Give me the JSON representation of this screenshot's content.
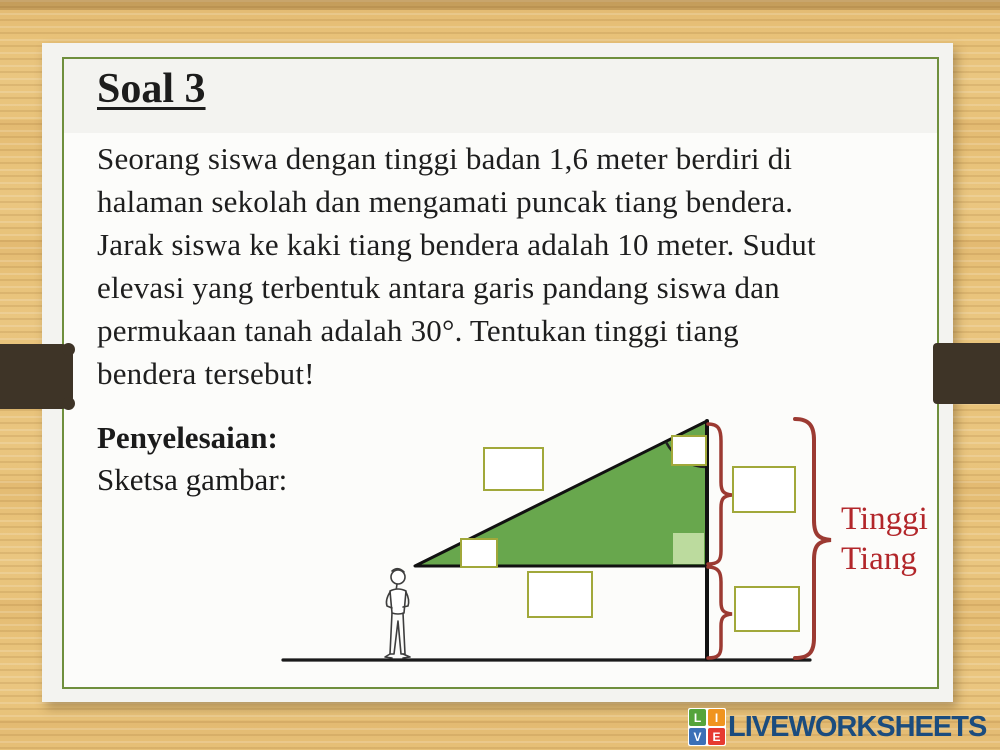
{
  "slide": {
    "title": "Soal 3",
    "problem_lines": [
      "Seorang siswa dengan tinggi badan 1,6 meter berdiri di",
      "halaman sekolah dan mengamati puncak tiang bendera.",
      "Jarak siswa ke kaki tiang bendera adalah 10 meter. Sudut",
      "elevasi yang terbentuk antara garis pandang siswa dan",
      "permukaan tanah adalah 30°. Tentukan tinggi tiang",
      "bendera tersebut!"
    ],
    "solution_label": "Penyelesaian:",
    "sketch_label": "Sketsa gambar:"
  },
  "diagram": {
    "pole_label_line1": "Tinggi",
    "pole_label_line2": "Tiang",
    "answer_boxes": [
      {
        "id": "hypotenuse-label-box",
        "value": ""
      },
      {
        "id": "apex-angle-box",
        "value": ""
      },
      {
        "id": "elevation-angle-box",
        "value": ""
      },
      {
        "id": "distance-label-box",
        "value": ""
      },
      {
        "id": "upper-height-box",
        "value": ""
      },
      {
        "id": "observer-height-box",
        "value": ""
      }
    ],
    "colors": {
      "triangle_fill": "#68a74d",
      "right_angle_fill": "#bcdb9e",
      "box_border": "#a1a83a",
      "brace": "#9c3a32",
      "label_red": "#b2262a",
      "line": "#1a1a1a"
    }
  },
  "footer": {
    "brand": "LIVEWORKSHEETS",
    "logo_letters": [
      "L",
      "I",
      "V",
      "E"
    ],
    "logo_colors": [
      "#55a43b",
      "#f0941f",
      "#3b70b7",
      "#e63a30"
    ],
    "brand_color": "#1b4c7e"
  }
}
